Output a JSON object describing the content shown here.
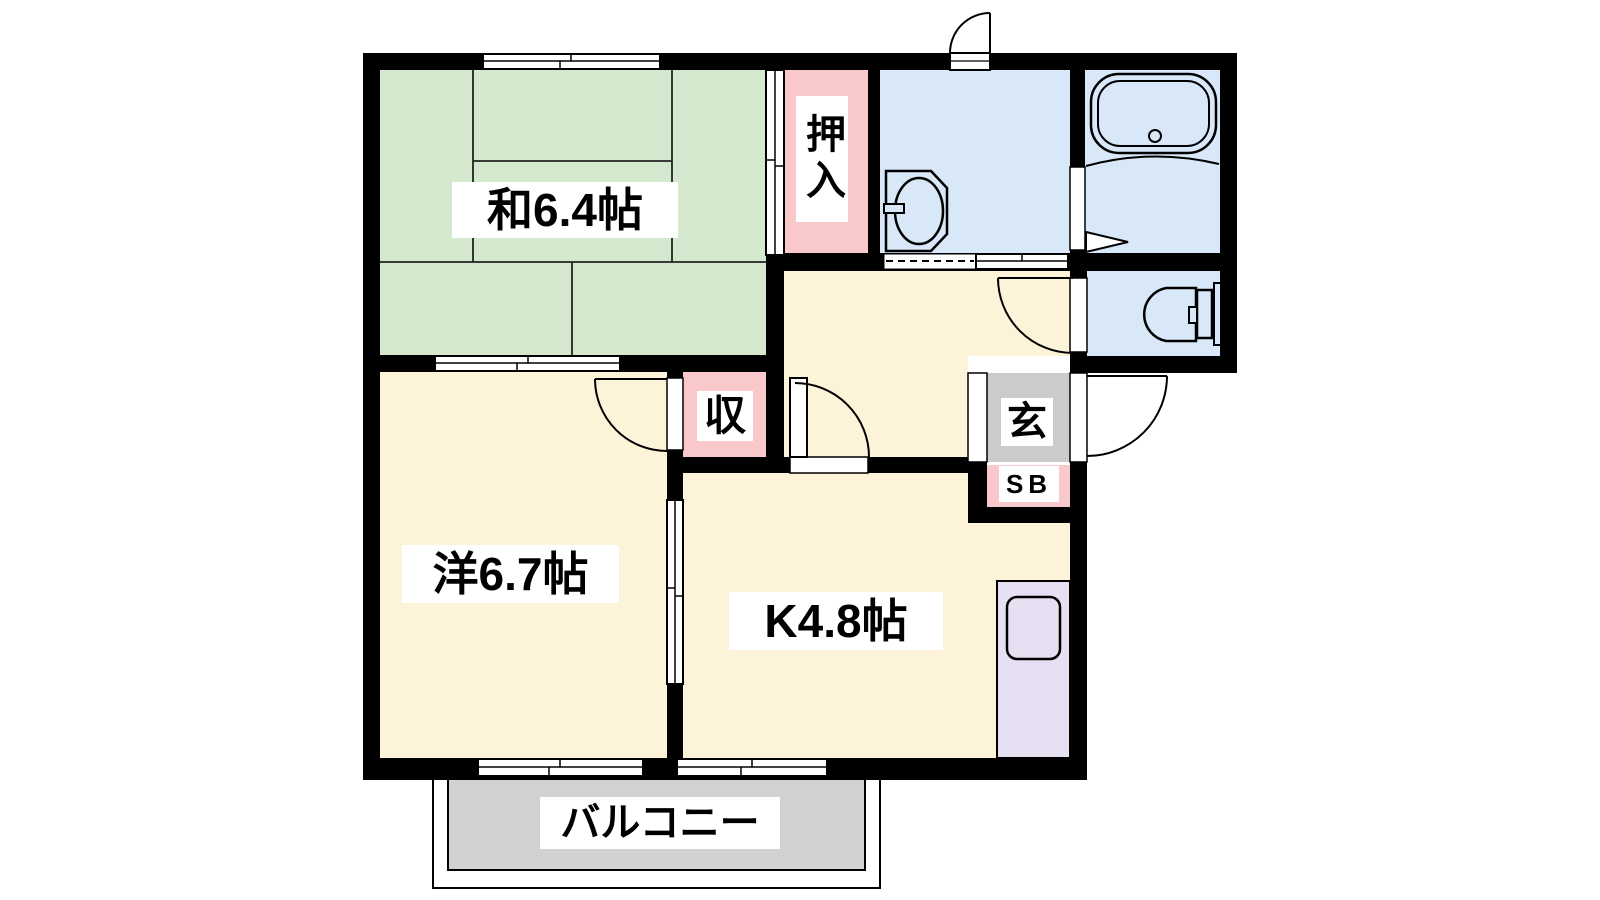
{
  "plan": {
    "rooms": {
      "japanese_room": {
        "label": "和6.4帖",
        "color": "#d4e8ce"
      },
      "oshiire": {
        "label": "押入",
        "color": "#f9c8ca"
      },
      "storage": {
        "label": "収",
        "color": "#f9c8ca"
      },
      "shoe_box": {
        "label": "SB",
        "color": "#f9c8ca"
      },
      "western_room": {
        "label": "洋6.7帖",
        "color": "#fcf3d8"
      },
      "kitchen": {
        "label": "K4.8帖",
        "color": "#fcf3d8"
      },
      "hallway": {
        "color": "#fcf3d8"
      },
      "washroom": {
        "color": "#d8e8f8"
      },
      "bathroom": {
        "color": "#d8e8f8"
      },
      "toilet": {
        "color": "#d8e8f8"
      },
      "genkan": {
        "label": "玄",
        "color": "#cbcbcb"
      },
      "kitchen_counter": {
        "color": "#e7e0f3"
      },
      "balcony": {
        "label": "バルコニー",
        "color": "#d2d2d2"
      }
    },
    "wall_color": "#000000"
  }
}
